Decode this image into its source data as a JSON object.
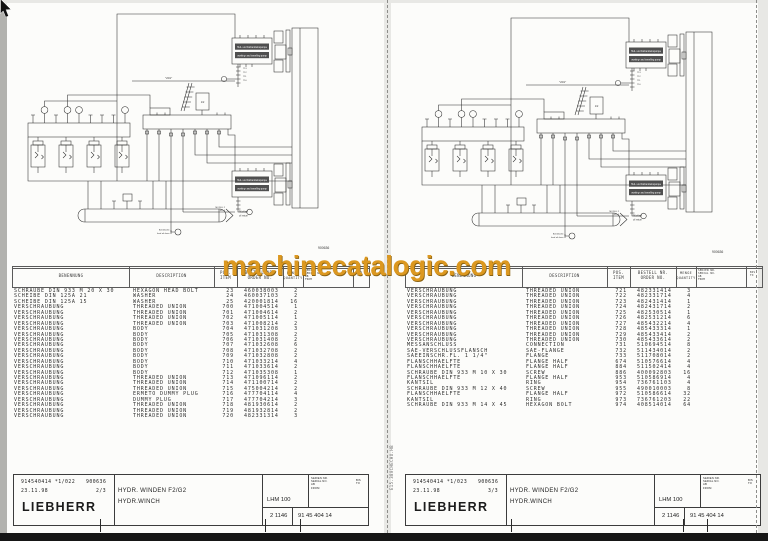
{
  "watermark": {
    "text": "machinecatalogic.com",
    "color": "#DC9820"
  },
  "side_note": "E15.380CHECHU.HB",
  "diagram": {
    "figure_number": "900636",
    "pump_label_de": "Hub- und Fahrantriebspumpe",
    "pump_label_en": "working- and travelling pump",
    "tank_label_de": "Rücklauf",
    "tank_label_en": "oil return",
    "drain_label_de": "Befüllstelle",
    "drain_label_en": "feed oil drain",
    "line_label": "\"201\"",
    "module_label": "MODUL 2",
    "module_sub": "411.4",
    "valve_box_label": "1/2",
    "callouts": [
      "713",
      "712",
      "711",
      "710"
    ]
  },
  "table_header": {
    "benennung": "BENENNUNG",
    "description": "DESCRIPTION",
    "pos1": "POS.",
    "pos2": "ITEM",
    "order1": "BESTELL NR.",
    "order2": "ORDER NO.",
    "qty1": "MENGE",
    "qty2": "QUANTITY",
    "serial1": "SERIEN NR.",
    "serial2": "SERIAL NO.",
    "serial3": "AB",
    "serial4": "FROM",
    "bis1": "BIS",
    "bis2": "TO"
  },
  "pages": [
    {
      "rows": [
        [
          "SCHRAUBE DIN 933 M 20 X 30",
          "HEXAGON HEAD BOLT",
          "23",
          "460038003",
          "2"
        ],
        [
          "SCHEIBE DIN 125A 21",
          "WASHER",
          "24",
          "460037103",
          "2"
        ],
        [
          "SCHEIBE DIN 125A 15",
          "WASHER",
          "25",
          "420001814",
          "16"
        ],
        [
          "VERSCHRAUBUNG",
          "THREADED UNION",
          "700",
          "471004514",
          "1"
        ],
        [
          "VERSCHRAUBUNG",
          "THREADED UNION",
          "701",
          "471004614",
          "2"
        ],
        [
          "VERSCHRAUBUNG",
          "THREADED UNION",
          "702",
          "471005114",
          "1"
        ],
        [
          "VERSCHRAUBUNG",
          "THREADED UNION",
          "703",
          "471008214",
          "2"
        ],
        [
          "VERSCHRAUBUNG",
          "BODY",
          "704",
          "471031208",
          "3"
        ],
        [
          "VERSCHRAUBUNG",
          "BODY",
          "705",
          "471031308",
          "2"
        ],
        [
          "VERSCHRAUBUNG",
          "BODY",
          "706",
          "471031408",
          "2"
        ],
        [
          "VERSCHRAUBUNG",
          "BODY",
          "707",
          "471032608",
          "6"
        ],
        [
          "VERSCHRAUBUNG",
          "BODY",
          "708",
          "471032708",
          "2"
        ],
        [
          "VERSCHRAUBUNG",
          "BODY",
          "709",
          "471032808",
          "2"
        ],
        [
          "VERSCHRAUBUNG",
          "BODY",
          "710",
          "471033214",
          "4"
        ],
        [
          "VERSCHRAUBUNG",
          "BODY",
          "711",
          "471033614",
          "2"
        ],
        [
          "VERSCHRAUBUNG",
          "BODY",
          "712",
          "471035308",
          "1"
        ],
        [
          "VERSCHRAUBUNG",
          "THREADED UNION",
          "713",
          "471096114",
          "2"
        ],
        [
          "VERSCHRAUBUNG",
          "THREADED UNION",
          "714",
          "471100714",
          "2"
        ],
        [
          "VERSCHRAUBUNG",
          "THREADED UNION",
          "715",
          "475004214",
          "2"
        ],
        [
          "VERSCHRAUBUNG",
          "ERMETO DUMMY PLUG",
          "716",
          "477704114",
          "4"
        ],
        [
          "VERSCHRAUBUNG",
          "DUMMY PLUG",
          "717",
          "477704214",
          "3"
        ],
        [
          "VERSCHRAUBUNG",
          "THREADED UNION",
          "718",
          "481930614",
          "2"
        ],
        [
          "VERSCHRAUBUNG",
          "THREADED UNION",
          "719",
          "481932814",
          "2"
        ],
        [
          "VERSCHRAUBUNG",
          "THREADED UNION",
          "720",
          "482331314",
          "3"
        ]
      ],
      "footer": {
        "doc": "914540414 *1/022",
        "code": "900636",
        "date": "23.11.98",
        "sheet": "2/3",
        "brand": "LIEBHERR",
        "title_de": "HYDR. WINDEN F2/G2",
        "title_en": "HYDR.WINCH",
        "model": "LHM 100",
        "num_left": "2 1146",
        "num_right": "91 45 404 14"
      }
    },
    {
      "rows": [
        [
          "VERSCHRAUBUNG",
          "THREADED UNION",
          "721",
          "482331414",
          "3"
        ],
        [
          "VERSCHRAUBUNG",
          "THREADED UNION",
          "722",
          "482331714",
          "4"
        ],
        [
          "VERSCHRAUBUNG",
          "THREADED UNION",
          "723",
          "482431414",
          "1"
        ],
        [
          "VERSCHRAUBUNG",
          "THREADED UNION",
          "724",
          "482431714",
          "2"
        ],
        [
          "VERSCHRAUBUNG",
          "THREADED UNION",
          "725",
          "482530514",
          "1"
        ],
        [
          "VERSCHRAUBUNG",
          "THREADED UNION",
          "726",
          "482531214",
          "6"
        ],
        [
          "VERSCHRAUBUNG",
          "THREADED UNION",
          "727",
          "485432214",
          "4"
        ],
        [
          "VERSCHRAUBUNG",
          "THREADED UNION",
          "728",
          "485433314",
          "1"
        ],
        [
          "VERSCHRAUBUNG",
          "THREADED UNION",
          "729",
          "485433414",
          "2"
        ],
        [
          "VERSCHRAUBUNG",
          "THREADED UNION",
          "730",
          "485433614",
          "2"
        ],
        [
          "MESSANSCHLUSS",
          "CONNECTION",
          "731",
          "510694514",
          "8"
        ],
        [
          "SAE-VERSCHLUSSFLANSCH",
          "SAE-FLANGE",
          "732",
          "511434014",
          "2"
        ],
        [
          "SAEEINSCHR.FL. 1 1/4\"",
          "FLANGE",
          "733",
          "511708014",
          "2"
        ],
        [
          "FLANSCHHAELFTE",
          "FLANGE HALF",
          "674",
          "510576614",
          "4"
        ],
        [
          "FLANSCHHAELFTE",
          "FLANGE HALF",
          "884",
          "511502414",
          "4"
        ],
        [
          "SCHRAUBE DIN 933 M 10 X 30",
          "SCREW",
          "886",
          "400092803",
          "16"
        ],
        [
          "FLANSCHHAELFTE",
          "FLANGE HALF",
          "953",
          "510586914",
          "4"
        ],
        [
          "KANTSIL",
          "RING",
          "954",
          "736761103",
          "4"
        ],
        [
          "SCHRAUBE DIN 933 M 12 X 40",
          "SCREW",
          "955",
          "490010003",
          "8"
        ],
        [
          "FLANSCHHAELFTE",
          "FLANGE HALF",
          "972",
          "510586614",
          "32"
        ],
        [
          "KANTSIL",
          "RING",
          "973",
          "736761203",
          "22"
        ],
        [
          "SCHRAUBE DIN 933 M 14 X 45",
          "HEXAGON BOLT",
          "974",
          "408514014",
          "64"
        ]
      ],
      "footer": {
        "doc": "914540414 *1/023",
        "code": "900636",
        "date": "23.11.98",
        "sheet": "3/3",
        "brand": "LIEBHERR",
        "title_de": "HYDR. WINDEN F2/G2",
        "title_en": "HYDR.WINCH",
        "model": "LHM 100",
        "num_left": "2 1146",
        "num_right": "91 45 404 14"
      }
    }
  ]
}
